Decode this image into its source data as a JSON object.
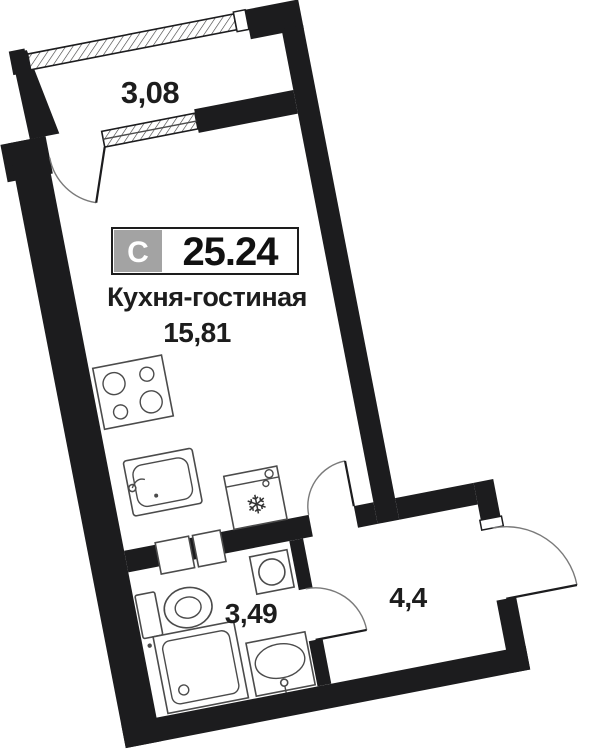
{
  "plan": {
    "unit_badge": {
      "type_letter": "С",
      "total_area": "25.24"
    },
    "rooms": {
      "balcony": {
        "area": "3,08"
      },
      "kitchen_living": {
        "name": "Кухня-гостиная",
        "area": "15,81"
      },
      "bathroom": {
        "area": "3,49"
      },
      "hallway": {
        "area": "4,4"
      }
    },
    "fixtures": [
      "stove-icon",
      "kitchen-sink-icon",
      "fridge-icon",
      "washing-machine-icon",
      "toilet-icon",
      "shower-icon",
      "wash-basin-icon"
    ],
    "openings": [
      "balcony-glazing",
      "balcony-window",
      "balcony-door",
      "room-hall-door",
      "bathroom-door",
      "entrance-door"
    ],
    "fridge_symbol": "❄",
    "colors": {
      "walls": "#1c1c1e",
      "fixtures": "#4b4b4b",
      "badge_bg": "#a3a3a3",
      "badge_text": "#ffffff",
      "background": "#ffffff",
      "label_text": "#1d1d1d"
    }
  }
}
